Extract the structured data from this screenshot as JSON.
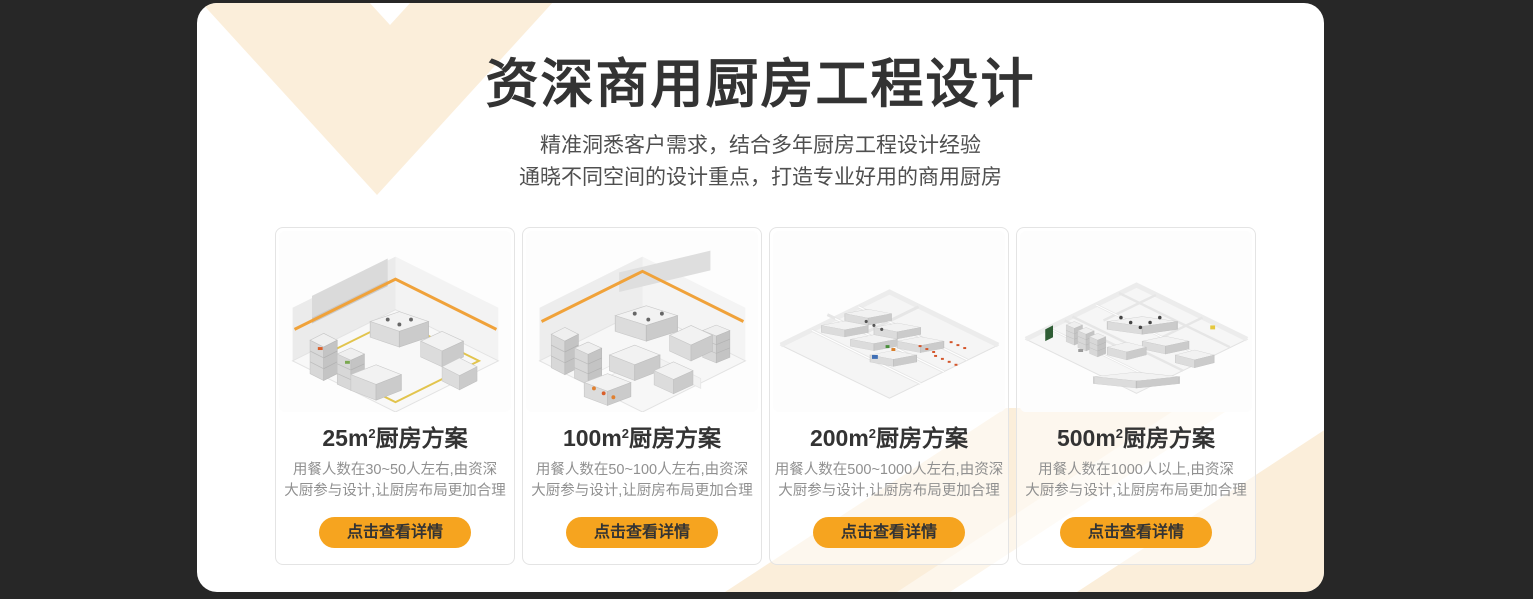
{
  "theme": {
    "page_background": "#272727",
    "panel_background": "#ffffff",
    "chevron_cream": "#fbeeda",
    "button_orange": "#f6a41f",
    "button_text": "#333333",
    "title_color": "#333333",
    "subtitle_color": "#4f4f4f",
    "card_desc_color": "#909090"
  },
  "header": {
    "title": "资深商用厨房工程设计",
    "subtitle_line1": "精准洞悉客户需求，结合多年厨房工程设计经验",
    "subtitle_line2": "通晓不同空间的设计重点，打造专业好用的商用厨房"
  },
  "cards": [
    {
      "title_prefix": "25m",
      "title_sup": "2",
      "title_suffix": "厨房方案",
      "desc_line1": "用餐人数在30~50人左右,由资深",
      "desc_line2": "大厨参与设计,让厨房布局更加合理",
      "button_label": "点击查看详情"
    },
    {
      "title_prefix": "100m",
      "title_sup": "2",
      "title_suffix": "厨房方案",
      "desc_line1": "用餐人数在50~100人左右,由资深",
      "desc_line2": "大厨参与设计,让厨房布局更加合理",
      "button_label": "点击查看详情"
    },
    {
      "title_prefix": "200m",
      "title_sup": "2",
      "title_suffix": "厨房方案",
      "desc_line1": "用餐人数在500~1000人左右,由资深",
      "desc_line2": "大厨参与设计,让厨房布局更加合理",
      "button_label": "点击查看详情"
    },
    {
      "title_prefix": "500m",
      "title_sup": "2",
      "title_suffix": "厨房方案",
      "desc_line1": "用餐人数在1000人以上,由资深",
      "desc_line2": "大厨参与设计,让厨房布局更加合理",
      "button_label": "点击查看详情"
    }
  ]
}
